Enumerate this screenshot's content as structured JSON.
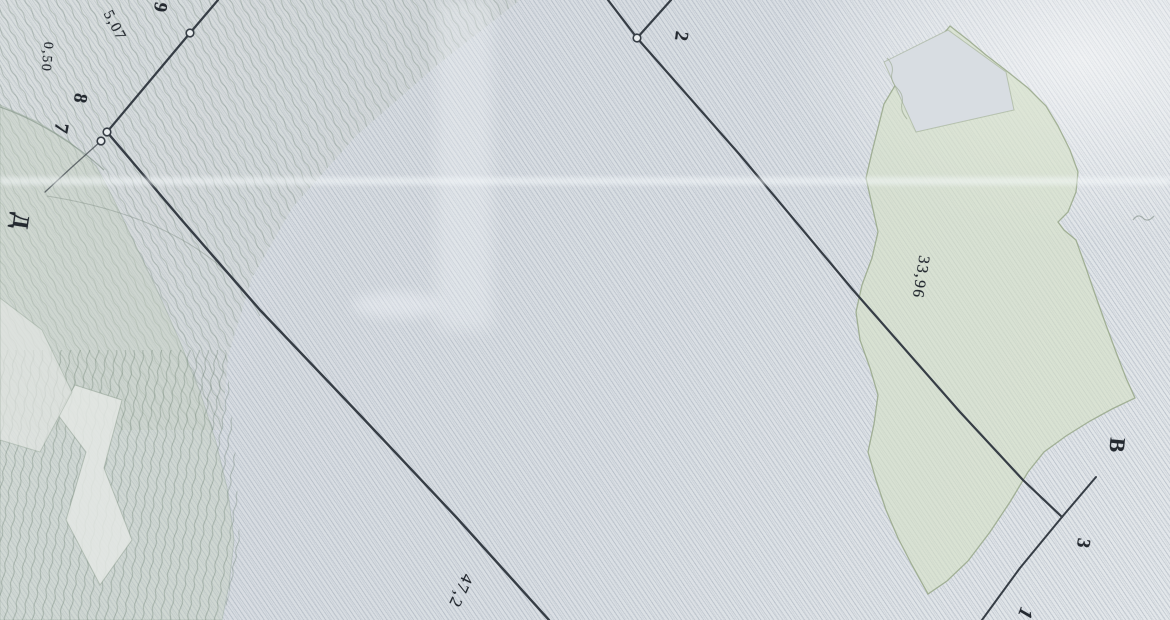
{
  "map": {
    "colors": {
      "paper_base": "#d9dee3",
      "hatch_line": "rgba(141,153,169,0.30)",
      "survey_line": "#363d45",
      "label_text": "#242930",
      "vegetation_fill": "rgba(213,224,198,0.62)",
      "vegetation_edge": "rgba(148,164,132,0.80)",
      "contour_tint": "rgba(196,208,190,0.42)",
      "point_marker_fill": "#e9edef"
    },
    "point_labels": [
      {
        "text": "9",
        "x": 160,
        "y": 7,
        "rot": 100,
        "size": 19,
        "bold": true,
        "italic": false
      },
      {
        "text": "8",
        "x": 80,
        "y": 98,
        "rot": 100,
        "size": 19,
        "bold": true,
        "italic": false
      },
      {
        "text": "7",
        "x": 61,
        "y": 128,
        "rot": 100,
        "size": 20,
        "bold": true,
        "italic": false
      },
      {
        "text": "Д",
        "x": 21,
        "y": 221,
        "rot": 98,
        "size": 23,
        "bold": true,
        "italic": false
      },
      {
        "text": "2",
        "x": 681,
        "y": 36,
        "rot": 98,
        "size": 19,
        "bold": true,
        "italic": false
      },
      {
        "text": "В",
        "x": 1117,
        "y": 445,
        "rot": 95,
        "size": 22,
        "bold": true,
        "italic": false
      },
      {
        "text": "3",
        "x": 1083,
        "y": 543,
        "rot": 100,
        "size": 19,
        "bold": true,
        "italic": false
      },
      {
        "text": "1",
        "x": 1025,
        "y": 613,
        "rot": 110,
        "size": 20,
        "bold": true,
        "italic": true
      }
    ],
    "dimension_labels": [
      {
        "text": "0,50",
        "x": 46,
        "y": 57,
        "rot": 95,
        "size": 14
      },
      {
        "text": "5,07",
        "x": 114,
        "y": 26,
        "rot": 62,
        "size": 15
      },
      {
        "text": "33,96",
        "x": 920,
        "y": 277,
        "rot": 99,
        "size": 16
      },
      {
        "text": "47,2",
        "x": 461,
        "y": 591,
        "rot": 115,
        "size": 17
      }
    ],
    "lines": [
      {
        "name": "boundary-line-2-up-left",
        "pts": [
          [
            608,
            0
          ],
          [
            637,
            38
          ]
        ],
        "w": 2.2,
        "op": 1
      },
      {
        "name": "boundary-line-2-up-right",
        "pts": [
          [
            671,
            0
          ],
          [
            637,
            38
          ]
        ],
        "w": 2.2,
        "op": 1
      },
      {
        "name": "boundary-line-2-to-3",
        "pts": [
          [
            637,
            38
          ],
          [
            740,
            155
          ],
          [
            853,
            290
          ],
          [
            960,
            412
          ],
          [
            1023,
            480
          ],
          [
            1062,
            517
          ]
        ],
        "w": 2.2,
        "op": 1
      },
      {
        "name": "boundary-line-9-to-7",
        "pts": [
          [
            218,
            0
          ],
          [
            190,
            33
          ],
          [
            107,
            132
          ]
        ],
        "w": 2.2,
        "op": 1
      },
      {
        "name": "boundary-line-7-to-bottom",
        "pts": [
          [
            107,
            132
          ],
          [
            180,
            218
          ],
          [
            260,
            310
          ],
          [
            360,
            415
          ],
          [
            457,
            518
          ],
          [
            549,
            620
          ]
        ],
        "w": 2.4,
        "op": 1
      },
      {
        "name": "boundary-line-7-fading",
        "pts": [
          [
            101,
            141
          ],
          [
            72,
            167
          ],
          [
            45,
            192
          ]
        ],
        "w": 1.3,
        "op": 0.7
      },
      {
        "name": "boundary-line-through-3",
        "pts": [
          [
            1096,
            477
          ],
          [
            1062,
            517
          ],
          [
            1020,
            568
          ],
          [
            982,
            620
          ]
        ],
        "w": 2.0,
        "op": 1
      }
    ],
    "points": [
      {
        "name": "survey-point-2",
        "x": 637,
        "y": 38
      },
      {
        "name": "survey-point-9",
        "x": 190,
        "y": 33
      },
      {
        "name": "survey-point-8",
        "x": 107,
        "y": 132
      },
      {
        "name": "survey-point-7",
        "x": 101,
        "y": 141
      }
    ],
    "regions": [
      {
        "name": "contour-zone-top-tint",
        "d": "M0,0 L520,0 L436,66 L356,136 L292,208 L252,278 L228,356 L222,430 L0,430 Z",
        "fill": "rgba(203,210,203,0.30)",
        "stroke": "none",
        "sw": 0
      },
      {
        "name": "contour-zone-top-pattern",
        "d": "M0,0 L520,0 L436,66 L356,136 L292,208 L252,278 L228,356 L222,430 L0,430 Z",
        "fill": "url(#ctrA)",
        "stroke": "none",
        "sw": 0
      },
      {
        "name": "left-slope-tint",
        "d": "M0,105 L38,122 L70,142 L96,166 L112,196 L134,242 L158,292 L180,342 L200,392 L216,442 L228,492 L234,540 L229,585 L222,620 L0,620 Z",
        "fill": "rgba(196,208,190,0.42)",
        "stroke": "rgba(130,148,132,0.30)",
        "sw": 1
      },
      {
        "name": "contour-zone-bottom-pattern",
        "d": "M0,350 L226,350 L236,460 L240,545 L228,600 L222,620 L0,620 Z",
        "fill": "url(#ctrB)",
        "stroke": "none",
        "sw": 0
      },
      {
        "name": "light-wedge-1",
        "d": "M75,385 L122,400 L104,468 L132,540 L100,585 L66,520 L86,452 L58,415 Z",
        "fill": "rgba(228,232,228,0.85)",
        "stroke": "rgba(130,148,132,0.45)",
        "sw": 1
      },
      {
        "name": "light-wedge-2",
        "d": "M0,298 L42,330 L72,392 L40,452 L0,440 Z",
        "fill": "rgba(226,230,227,0.70)",
        "stroke": "rgba(130,148,132,0.35)",
        "sw": 1
      },
      {
        "name": "vegetation-area",
        "d": "M950,26 L968,40 L986,55 L1008,72 L1028,88 L1046,106 L1058,126 L1070,150 L1078,172 L1076,192 L1068,212 L1058,222 L1064,230 L1076,240 L1086,268 L1096,297 L1106,325 L1116,352 L1126,378 L1135,398 L1112,409 L1090,421 L1066,436 L1044,452 L1028,472 L1010,502 L990,532 L968,561 L947,581 L928,594 L912,565 L898,538 L886,510 L876,480 L868,452 L874,424 L878,395 L870,368 L860,340 L856,312 L862,285 L872,258 L878,232 L872,205 L866,178 L872,152 L878,128 L884,104 L896,84 L912,68 L930,50 Z",
        "fill": "rgba(213,224,198,0.62)",
        "stroke": "rgba(148,164,132,0.80)",
        "sw": 1.3
      },
      {
        "name": "vegetation-notch",
        "d": "M884,62 L948,30 L1006,72 L1014,110 L916,132 Z",
        "fill": "#d8dde2",
        "stroke": "rgba(148,164,132,0.50)",
        "sw": 1
      }
    ],
    "faint_paths": [
      {
        "name": "terrain-edge-arc",
        "d": "M0,107 C38,120 78,146 104,170",
        "stroke": "rgba(120,138,125,0.55)",
        "w": 1.2
      },
      {
        "name": "terrain-edge-continuation",
        "d": "M47,196 C110,206 170,226 215,262 C238,282 252,300 260,316",
        "stroke": "rgba(130,145,135,0.45)",
        "w": 1.0
      },
      {
        "name": "scallop-edge",
        "d": "M887,58 q7,7 5,15 q-2,8 5,15 q7,7 5,15 q-2,8 5,16",
        "stroke": "rgba(150,165,140,0.60)",
        "w": 1.0
      },
      {
        "name": "pencil-squiggle",
        "d": "M1133,220 q5,-7 10,-2 q5,5 11,-2",
        "stroke": "rgba(120,135,125,0.55)",
        "w": 1.2
      }
    ]
  }
}
